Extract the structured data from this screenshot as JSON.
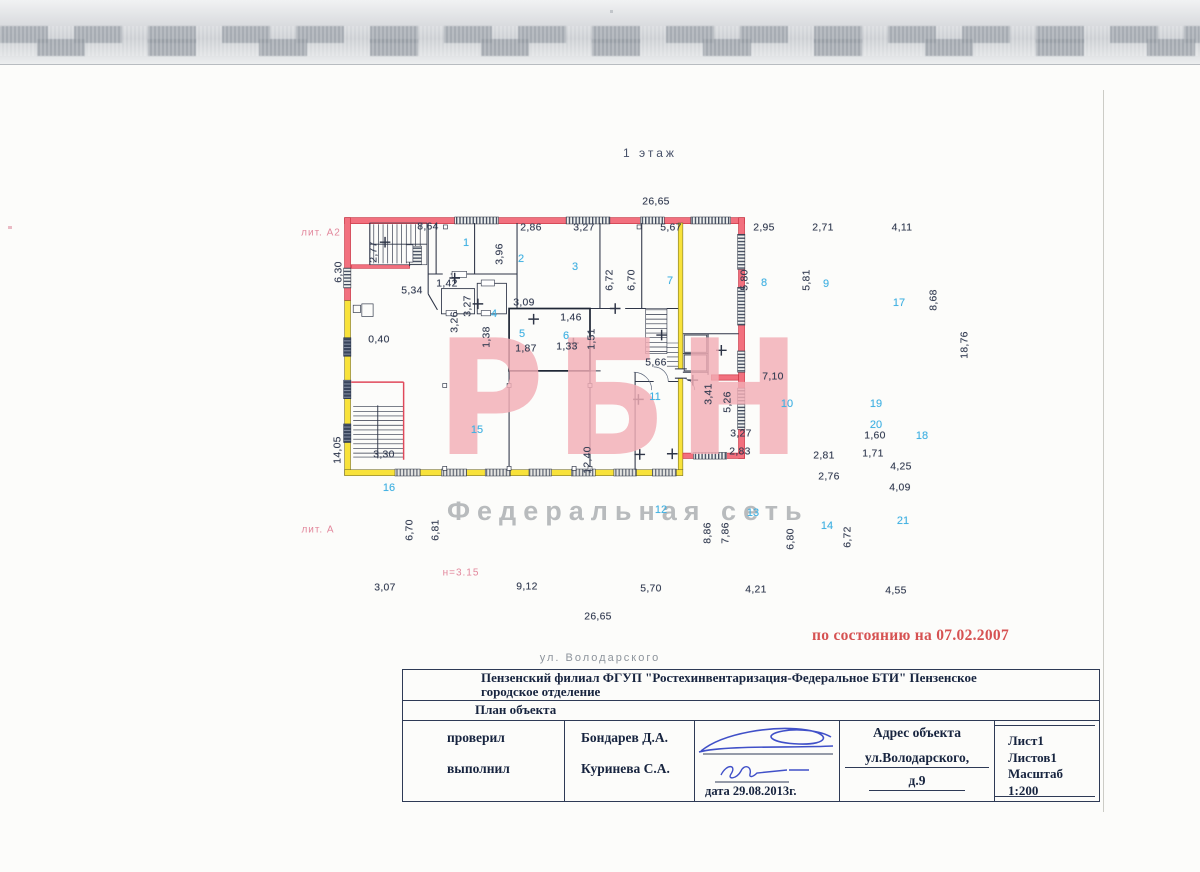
{
  "colors": {
    "wall_pink": "#f2707e",
    "wall_pink_edge": "#c7303f",
    "wall_yellow": "#f8e23a",
    "interior_wall": "#2e3547",
    "room_number": "#3fb0e2",
    "dimension_text": "#333c52",
    "watermark_pink": "#f3aeb6",
    "watermark_gray": "#b8bbbd",
    "status_red": "#d65252",
    "annotation_pink": "#e2879c",
    "signature_ink": "#4050c8"
  },
  "scan": {
    "status_note": "по состоянию на 07.02.2007",
    "street_label": "ул. Володарского"
  },
  "watermark": {
    "logo": "РБН",
    "subtitle": "Федеральная сеть"
  },
  "plan": {
    "floor_title": "1 этаж",
    "dimensions": [
      {
        "t": "26,65",
        "x": 656,
        "y": 202
      },
      {
        "t": "8,64",
        "x": 428,
        "y": 227
      },
      {
        "t": "2,86",
        "x": 531,
        "y": 228
      },
      {
        "t": "3,27",
        "x": 584,
        "y": 228
      },
      {
        "t": "5,67",
        "x": 671,
        "y": 228
      },
      {
        "t": "2,95",
        "x": 764,
        "y": 228
      },
      {
        "t": "2,71",
        "x": 823,
        "y": 228
      },
      {
        "t": "4,11",
        "x": 902,
        "y": 228
      },
      {
        "t": "2,77",
        "x": 374,
        "y": 252,
        "v": 1
      },
      {
        "t": "3,96",
        "x": 500,
        "y": 254,
        "v": 1
      },
      {
        "t": "6,72",
        "x": 610,
        "y": 280,
        "v": 1
      },
      {
        "t": "6,70",
        "x": 632,
        "y": 280,
        "v": 1
      },
      {
        "t": "5,80",
        "x": 745,
        "y": 280,
        "v": 1
      },
      {
        "t": "5,81",
        "x": 807,
        "y": 280,
        "v": 1
      },
      {
        "t": "8,68",
        "x": 934,
        "y": 300,
        "v": 1
      },
      {
        "t": "18,76",
        "x": 965,
        "y": 345,
        "v": 1
      },
      {
        "t": "6,30",
        "x": 339,
        "y": 272,
        "v": 1
      },
      {
        "t": "14,05",
        "x": 338,
        "y": 450,
        "v": 1
      },
      {
        "t": "5,34",
        "x": 412,
        "y": 291
      },
      {
        "t": "1,42",
        "x": 447,
        "y": 284
      },
      {
        "t": "3,27",
        "x": 468,
        "y": 306,
        "v": 1
      },
      {
        "t": "3,26",
        "x": 455,
        "y": 322,
        "v": 1
      },
      {
        "t": "3,09",
        "x": 524,
        "y": 303
      },
      {
        "t": "1,46",
        "x": 571,
        "y": 318
      },
      {
        "t": "1,38",
        "x": 487,
        "y": 337,
        "v": 1
      },
      {
        "t": "1,87",
        "x": 526,
        "y": 349
      },
      {
        "t": "1,33",
        "x": 567,
        "y": 347
      },
      {
        "t": "1,51",
        "x": 592,
        "y": 339,
        "v": 1
      },
      {
        "t": "0,40",
        "x": 379,
        "y": 340
      },
      {
        "t": "5,66",
        "x": 656,
        "y": 363
      },
      {
        "t": "7,10",
        "x": 773,
        "y": 377
      },
      {
        "t": "3,41",
        "x": 709,
        "y": 394,
        "v": 1
      },
      {
        "t": "5,26",
        "x": 728,
        "y": 402,
        "v": 1
      },
      {
        "t": "12,40",
        "x": 588,
        "y": 460,
        "v": 1
      },
      {
        "t": "3,27",
        "x": 741,
        "y": 434
      },
      {
        "t": "2,83",
        "x": 740,
        "y": 452
      },
      {
        "t": "2,81",
        "x": 824,
        "y": 456
      },
      {
        "t": "2,76",
        "x": 829,
        "y": 477
      },
      {
        "t": "1,60",
        "x": 875,
        "y": 436
      },
      {
        "t": "1,71",
        "x": 873,
        "y": 454
      },
      {
        "t": "4,25",
        "x": 901,
        "y": 467
      },
      {
        "t": "4,09",
        "x": 900,
        "y": 488
      },
      {
        "t": "3,30",
        "x": 384,
        "y": 455
      },
      {
        "t": "6,70",
        "x": 410,
        "y": 530,
        "v": 1
      },
      {
        "t": "6,81",
        "x": 436,
        "y": 530,
        "v": 1
      },
      {
        "t": "8,86",
        "x": 708,
        "y": 533,
        "v": 1
      },
      {
        "t": "7,86",
        "x": 726,
        "y": 533,
        "v": 1
      },
      {
        "t": "6,80",
        "x": 791,
        "y": 539,
        "v": 1
      },
      {
        "t": "6,72",
        "x": 848,
        "y": 537,
        "v": 1
      },
      {
        "t": "3,07",
        "x": 385,
        "y": 588
      },
      {
        "t": "9,12",
        "x": 527,
        "y": 587
      },
      {
        "t": "5,70",
        "x": 651,
        "y": 589
      },
      {
        "t": "4,21",
        "x": 756,
        "y": 590
      },
      {
        "t": "4,55",
        "x": 896,
        "y": 591
      },
      {
        "t": "26,65",
        "x": 598,
        "y": 617
      }
    ],
    "rooms": [
      {
        "n": "1",
        "x": 466,
        "y": 243
      },
      {
        "n": "2",
        "x": 521,
        "y": 259
      },
      {
        "n": "3",
        "x": 575,
        "y": 267
      },
      {
        "n": "4",
        "x": 494,
        "y": 314
      },
      {
        "n": "5",
        "x": 522,
        "y": 334
      },
      {
        "n": "6",
        "x": 566,
        "y": 336
      },
      {
        "n": "7",
        "x": 670,
        "y": 281
      },
      {
        "n": "8",
        "x": 764,
        "y": 283
      },
      {
        "n": "9",
        "x": 826,
        "y": 284
      },
      {
        "n": "10",
        "x": 787,
        "y": 404
      },
      {
        "n": "11",
        "x": 655,
        "y": 397
      },
      {
        "n": "12",
        "x": 661,
        "y": 510
      },
      {
        "n": "13",
        "x": 753,
        "y": 513
      },
      {
        "n": "14",
        "x": 827,
        "y": 526
      },
      {
        "n": "15",
        "x": 477,
        "y": 430
      },
      {
        "n": "16",
        "x": 389,
        "y": 488
      },
      {
        "n": "17",
        "x": 899,
        "y": 303
      },
      {
        "n": "18",
        "x": 922,
        "y": 436
      },
      {
        "n": "19",
        "x": 876,
        "y": 404
      },
      {
        "n": "20",
        "x": 876,
        "y": 425
      },
      {
        "n": "21",
        "x": 903,
        "y": 521
      }
    ],
    "annotations": [
      {
        "t": "лит. А2",
        "x": 321,
        "y": 233
      },
      {
        "t": "лит. А",
        "x": 318,
        "y": 530
      },
      {
        "t": "н=3.15",
        "x": 461,
        "y": 573
      }
    ]
  },
  "title_block": {
    "organization_line1": "Пензенский филиал ФГУП \"Ростехинвентаризация-Федеральное БТИ\" Пензенское",
    "organization_line2": "городское отделение",
    "document_type": "План объекта",
    "checked_label": "проверил",
    "checked_name": "Бондарев Д.А.",
    "performed_label": "выполнил",
    "performed_name": "Куринева С.А.",
    "date_label": "дата 29.08.2013г.",
    "address_label": "Адрес объекта",
    "address_line1": "ул.Володарского,",
    "address_line2": "д.9",
    "sheet": "Лист1",
    "sheets": "Листов1",
    "scale": "Масштаб 1:200"
  }
}
